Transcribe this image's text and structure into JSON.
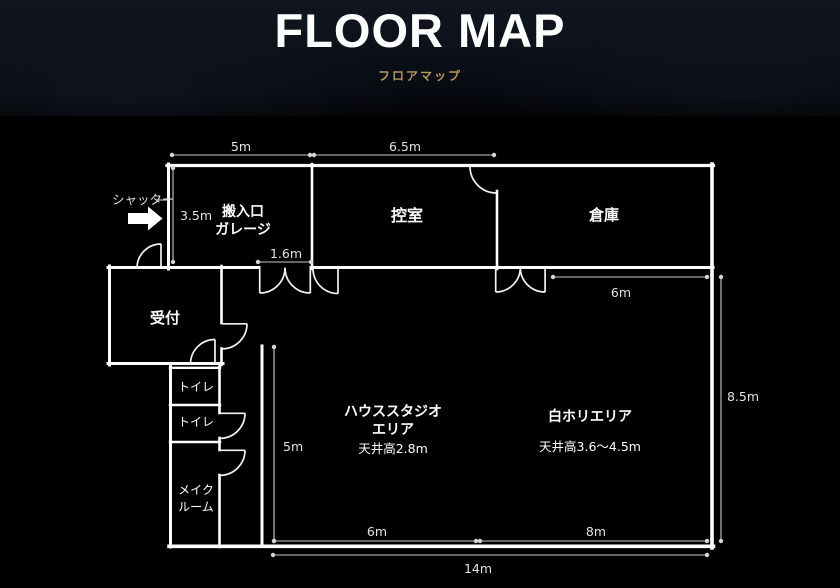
{
  "header": {
    "title": "FLOOR MAP",
    "subtitle": "フロアマップ",
    "accent_color": "#b5975f"
  },
  "floor_plan": {
    "shutter_label": "シャッター",
    "rooms": {
      "garage": {
        "line1": "搬入口",
        "line2": "ガレージ"
      },
      "waiting_room": "控室",
      "warehouse": "倉庫",
      "reception": "受付",
      "toilet1": "トイレ",
      "toilet2": "トイレ",
      "makeup": {
        "line1": "メイク",
        "line2": "ルーム"
      },
      "house_studio": {
        "line1": "ハウススタジオ",
        "line2": "エリア",
        "ceiling": "天井高2.8m"
      },
      "white_cyc": {
        "name": "白ホリエリア",
        "ceiling": "天井高3.6〜4.5m"
      }
    },
    "dimensions": {
      "top_garage": "5m",
      "top_waiting": "6.5m",
      "garage_height": "3.5m",
      "door_opening": "1.6m",
      "warehouse_bottom": "6m",
      "right_height": "8.5m",
      "studio_left": "5m",
      "bottom_left": "6m",
      "bottom_right": "8m",
      "bottom_total": "14m"
    },
    "colors": {
      "wall": "#ffffff",
      "background": "#000000",
      "dimension": "#c9c9c9"
    }
  }
}
